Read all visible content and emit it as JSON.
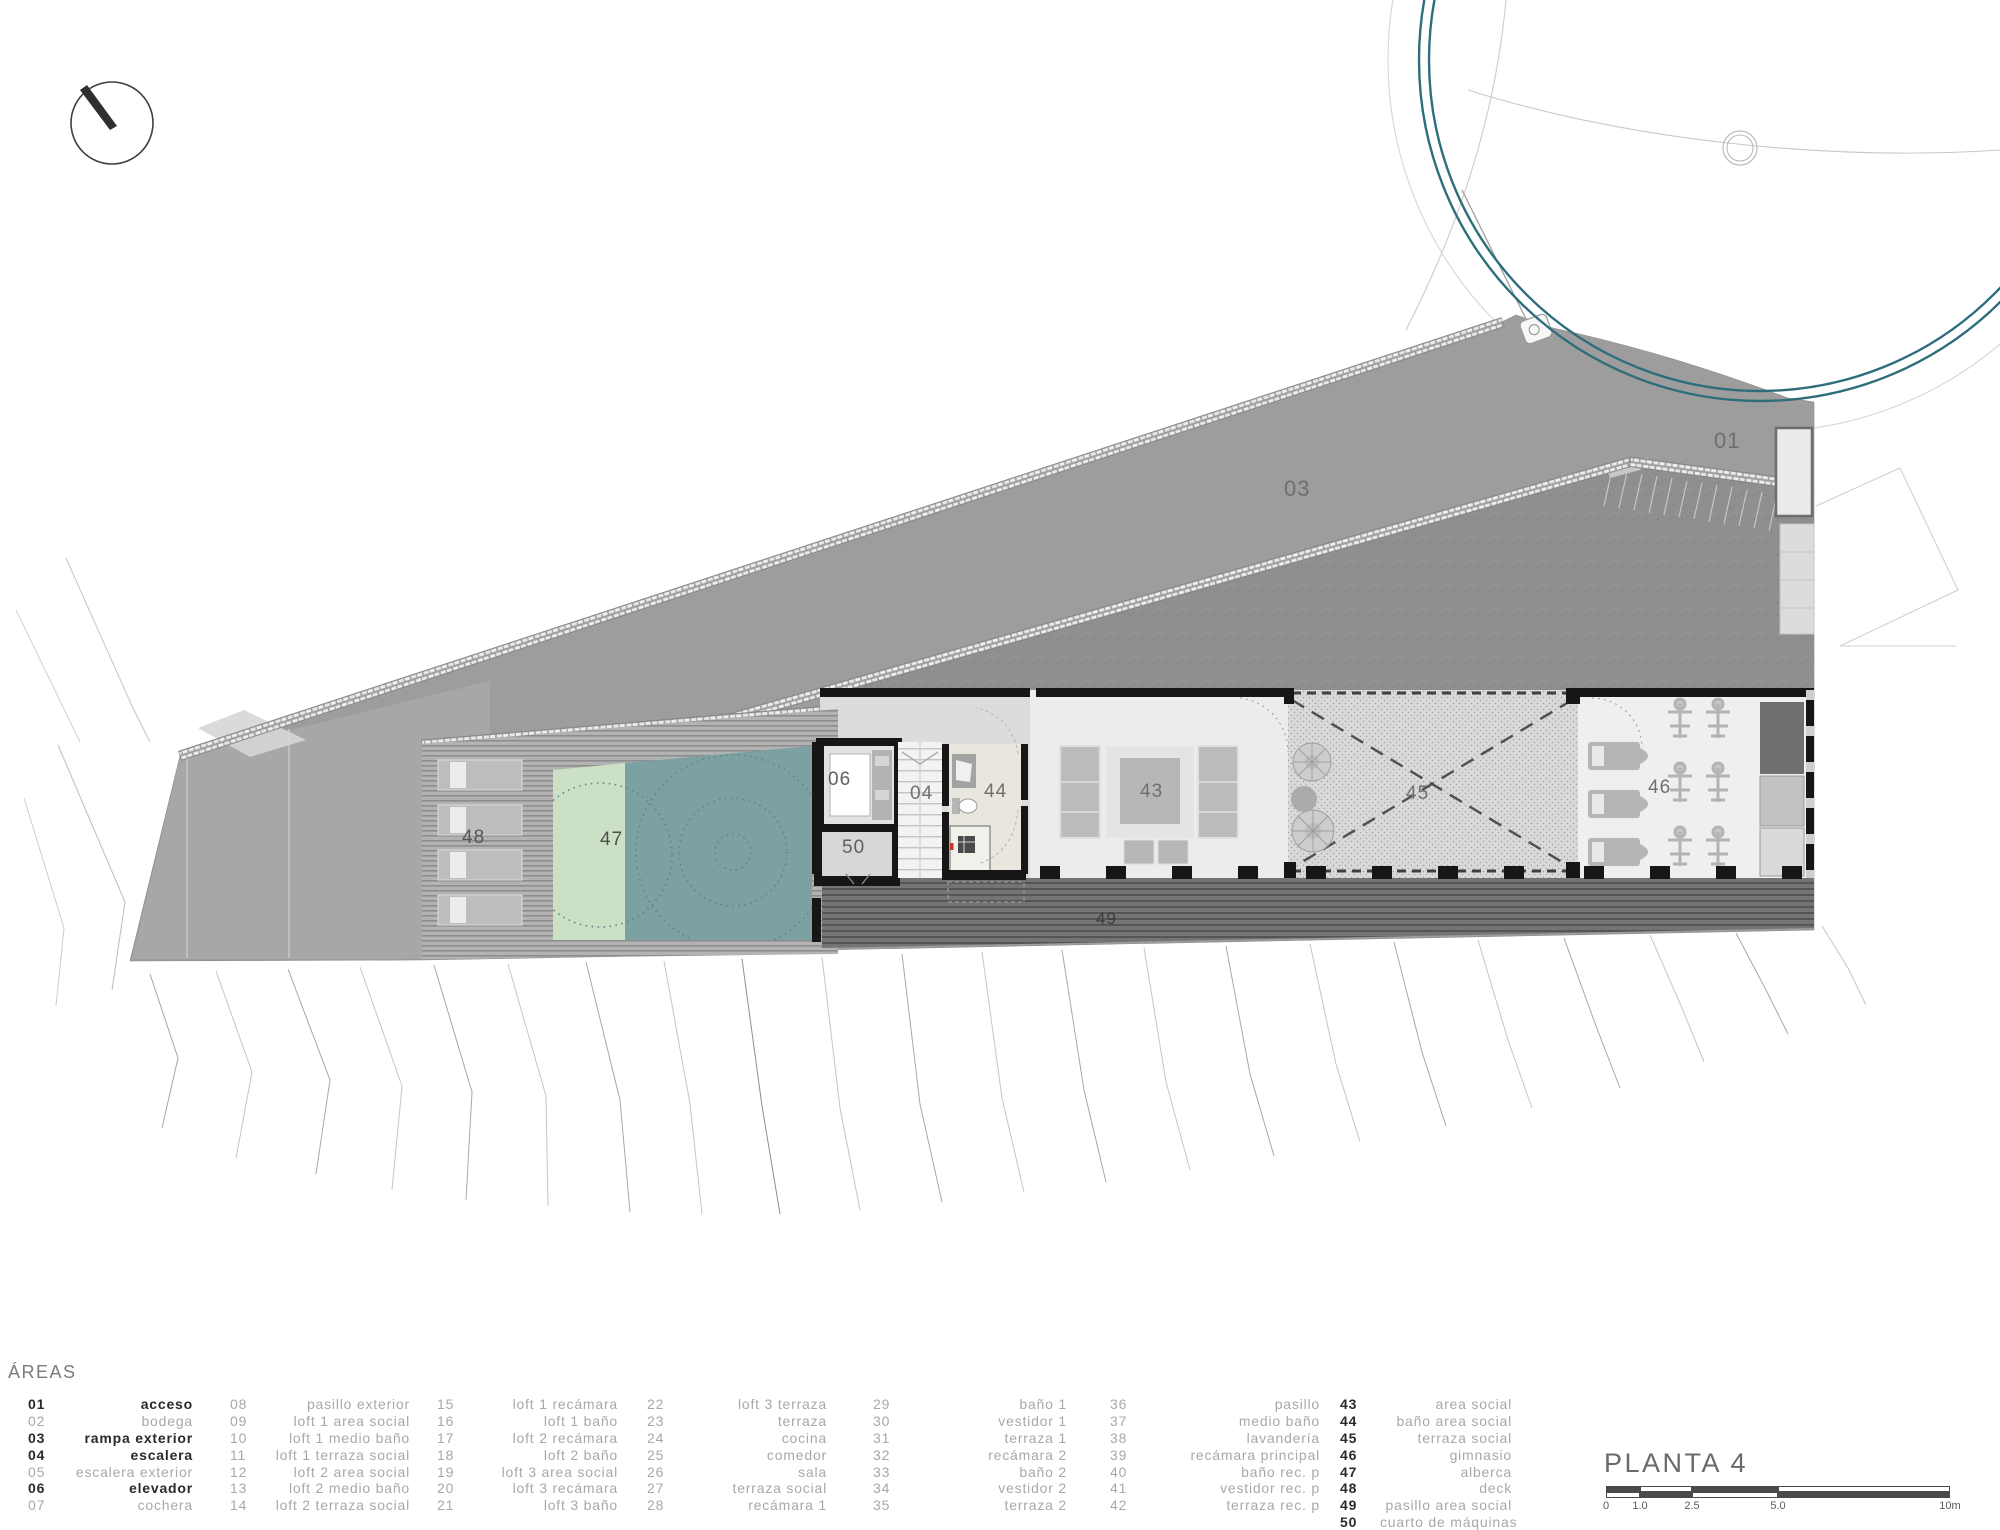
{
  "legend": {
    "header": "ÁREAS",
    "columns": [
      {
        "items": [
          {
            "num": "01",
            "label": "acceso",
            "style": "active"
          },
          {
            "num": "02",
            "label": "bodega",
            "style": "dim"
          },
          {
            "num": "03",
            "label": "rampa exterior",
            "style": "active"
          },
          {
            "num": "04",
            "label": "escalera",
            "style": "active"
          },
          {
            "num": "05",
            "label": "escalera exterior",
            "style": "dim"
          },
          {
            "num": "06",
            "label": "elevador",
            "style": "active"
          },
          {
            "num": "07",
            "label": "cochera",
            "style": "dim"
          }
        ]
      },
      {
        "items": [
          {
            "num": "08",
            "label": "pasillo exterior",
            "style": "dim"
          },
          {
            "num": "09",
            "label": "loft 1 area social",
            "style": "dim"
          },
          {
            "num": "10",
            "label": "loft 1 medio baño",
            "style": "dim"
          },
          {
            "num": "11",
            "label": "loft 1 terraza social",
            "style": "dim"
          },
          {
            "num": "12",
            "label": "loft 2 area social",
            "style": "dim"
          },
          {
            "num": "13",
            "label": "loft 2 medio baño",
            "style": "dim"
          },
          {
            "num": "14",
            "label": "loft 2 terraza social",
            "style": "dim"
          }
        ]
      },
      {
        "items": [
          {
            "num": "15",
            "label": "loft 1 recámara",
            "style": "dim"
          },
          {
            "num": "16",
            "label": "loft 1 baño",
            "style": "dim"
          },
          {
            "num": "17",
            "label": "loft 2 recámara",
            "style": "dim"
          },
          {
            "num": "18",
            "label": "loft 2 baño",
            "style": "dim"
          },
          {
            "num": "19",
            "label": "loft 3 area social",
            "style": "dim"
          },
          {
            "num": "20",
            "label": "loft 3 recámara",
            "style": "dim"
          },
          {
            "num": "21",
            "label": "loft 3 baño",
            "style": "dim"
          }
        ]
      },
      {
        "items": [
          {
            "num": "22",
            "label": "loft 3 terraza",
            "style": "dim"
          },
          {
            "num": "23",
            "label": "terraza",
            "style": "dim"
          },
          {
            "num": "24",
            "label": "cocina",
            "style": "dim"
          },
          {
            "num": "25",
            "label": "comedor",
            "style": "dim"
          },
          {
            "num": "26",
            "label": "sala",
            "style": "dim"
          },
          {
            "num": "27",
            "label": "terraza social",
            "style": "dim"
          },
          {
            "num": "28",
            "label": "recámara 1",
            "style": "dim"
          }
        ]
      },
      {
        "items": [
          {
            "num": "29",
            "label": "baño 1",
            "style": "dim"
          },
          {
            "num": "30",
            "label": "vestidor 1",
            "style": "dim"
          },
          {
            "num": "31",
            "label": "terraza 1",
            "style": "dim"
          },
          {
            "num": "32",
            "label": "recámara 2",
            "style": "dim"
          },
          {
            "num": "33",
            "label": "baño 2",
            "style": "dim"
          },
          {
            "num": "34",
            "label": "vestidor 2",
            "style": "dim"
          },
          {
            "num": "35",
            "label": "terraza 2",
            "style": "dim"
          }
        ]
      },
      {
        "items": [
          {
            "num": "36",
            "label": "pasillo",
            "style": "dim"
          },
          {
            "num": "37",
            "label": "medio baño",
            "style": "dim"
          },
          {
            "num": "38",
            "label": "lavandería",
            "style": "dim"
          },
          {
            "num": "39",
            "label": "recámara principal",
            "style": "dim"
          },
          {
            "num": "40",
            "label": "baño rec. p",
            "style": "dim"
          },
          {
            "num": "41",
            "label": "vestidor rec. p",
            "style": "dim"
          },
          {
            "num": "42",
            "label": "terraza rec. p",
            "style": "dim"
          }
        ]
      },
      {
        "items": [
          {
            "num": "43",
            "label": "area social",
            "style": "num-active"
          },
          {
            "num": "44",
            "label": "baño area social",
            "style": "num-active"
          },
          {
            "num": "45",
            "label": "terraza social",
            "style": "num-active"
          },
          {
            "num": "46",
            "label": "gimnasio",
            "style": "num-active"
          },
          {
            "num": "47",
            "label": "alberca",
            "style": "num-active"
          },
          {
            "num": "48",
            "label": "deck",
            "style": "num-active"
          },
          {
            "num": "49",
            "label": "pasillo area social",
            "style": "num-active"
          },
          {
            "num": "50",
            "label": "cuarto de máquinas",
            "style": "num-active"
          }
        ]
      }
    ]
  },
  "titleblock": {
    "plan_name": "PLANTA 4",
    "scale_ticks": [
      "0",
      "1.0",
      "2.5",
      "5.0",
      "10m"
    ]
  },
  "plan_labels": [
    {
      "id": "01",
      "x": 1714,
      "y": 430,
      "size": 22,
      "color": "#6f6f6f"
    },
    {
      "id": "03",
      "x": 1284,
      "y": 478,
      "size": 22,
      "color": "#6f6f6f"
    },
    {
      "id": "06",
      "x": 828,
      "y": 770,
      "size": 19,
      "color": "#5f5f5f"
    },
    {
      "id": "04",
      "x": 910,
      "y": 784,
      "size": 19,
      "color": "#6f6f6f"
    },
    {
      "id": "50",
      "x": 842,
      "y": 838,
      "size": 19,
      "color": "#5f5f5f"
    },
    {
      "id": "44",
      "x": 984,
      "y": 782,
      "size": 19,
      "color": "#6f6f6f"
    },
    {
      "id": "43",
      "x": 1140,
      "y": 782,
      "size": 19,
      "color": "#6f6f6f"
    },
    {
      "id": "45",
      "x": 1406,
      "y": 784,
      "size": 19,
      "color": "#6f6f6f"
    },
    {
      "id": "46",
      "x": 1648,
      "y": 778,
      "size": 19,
      "color": "#6f6f6f"
    },
    {
      "id": "47",
      "x": 600,
      "y": 830,
      "size": 19,
      "color": "#4f4f4f"
    },
    {
      "id": "48",
      "x": 462,
      "y": 828,
      "size": 19,
      "color": "#565656"
    },
    {
      "id": "49",
      "x": 1096,
      "y": 910,
      "size": 17,
      "color": "#3c3c3c"
    }
  ],
  "colors": {
    "teal_ring": "#2e6e7c",
    "pool_deep": "#7ba1a2",
    "pool_shallow": "#cbe0c4",
    "roof_gray": "#9d9d9d",
    "wall_black": "#161616",
    "active_text": "#2a2a2a",
    "dim_text": "#a8a8a8"
  }
}
